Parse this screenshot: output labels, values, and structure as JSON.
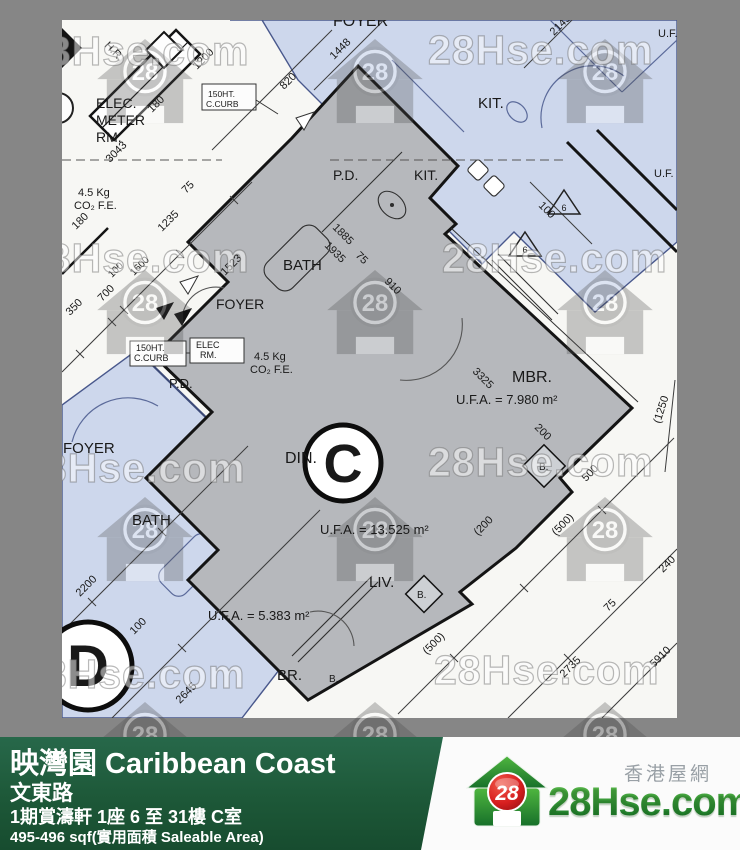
{
  "watermark": {
    "text": "28Hse.com",
    "badge": "28"
  },
  "info_bar": {
    "title": "映灣園 Caribbean Coast",
    "road": "文東路",
    "block": "1期賞濤軒 1座 6 至 31樓 C室",
    "area": "495-496 sqf(實用面積 Saleable Area)"
  },
  "logo": {
    "badge": "28",
    "name": "28Hse.com",
    "tagline": "香港屋網"
  },
  "plan": {
    "unit_letter_c": "C",
    "unit_letter_d": "D",
    "labels": [
      {
        "t": "FOYER",
        "x": 271,
        "y": 6,
        "s": 16
      },
      {
        "t": "KIT.",
        "x": 416,
        "y": 88,
        "s": 15
      },
      {
        "t": "U.F.",
        "x": 596,
        "y": 17,
        "s": 11
      },
      {
        "t": "U.F.",
        "x": 592,
        "y": 157,
        "s": 11
      },
      {
        "t": "P.D.",
        "x": 271,
        "y": 160,
        "s": 14
      },
      {
        "t": "KIT.",
        "x": 352,
        "y": 160,
        "s": 14
      },
      {
        "t": "ELEC.",
        "x": 34,
        "y": 88,
        "s": 14
      },
      {
        "t": "METER",
        "x": 34,
        "y": 105,
        "s": 14
      },
      {
        "t": "RM.",
        "x": 34,
        "y": 122,
        "s": 14
      },
      {
        "t": "150HT.",
        "x": 146,
        "y": 77,
        "s": 8.5
      },
      {
        "t": "C.CURB",
        "x": 144,
        "y": 87,
        "s": 8.5
      },
      {
        "t": "H.R.",
        "x": 42,
        "y": 26,
        "s": 11,
        "r": 45
      },
      {
        "t": "BATH",
        "x": 221,
        "y": 250,
        "s": 15
      },
      {
        "t": "FOYER",
        "x": 154,
        "y": 289,
        "s": 14
      },
      {
        "t": "ELEC",
        "x": 134,
        "y": 328,
        "s": 9
      },
      {
        "t": "RM.",
        "x": 138,
        "y": 338,
        "s": 9
      },
      {
        "t": "150HT.",
        "x": 74,
        "y": 331,
        "s": 9
      },
      {
        "t": "C.CURB",
        "x": 72,
        "y": 341,
        "s": 9
      },
      {
        "t": "4.5 Kg",
        "x": 16,
        "y": 176,
        "s": 11
      },
      {
        "t": "CO₂ F.E.",
        "x": 12,
        "y": 189,
        "s": 11
      },
      {
        "t": "4.5 Kg",
        "x": 192,
        "y": 340,
        "s": 11
      },
      {
        "t": "CO₂ F.E.",
        "x": 188,
        "y": 353,
        "s": 11
      },
      {
        "t": "P.D.",
        "x": 107,
        "y": 368,
        "s": 13
      },
      {
        "t": "DIN.",
        "x": 223,
        "y": 443,
        "s": 16
      },
      {
        "t": "MBR.",
        "x": 450,
        "y": 362,
        "s": 16
      },
      {
        "t": "U.F.A. = 7.980 m²",
        "x": 394,
        "y": 384,
        "s": 13
      },
      {
        "t": "U.F.A. = 13.525 m²",
        "x": 258,
        "y": 514,
        "s": 13
      },
      {
        "t": "U.F.A. = 5.383 m²",
        "x": 146,
        "y": 600,
        "s": 13
      },
      {
        "t": "LIV.",
        "x": 307,
        "y": 567,
        "s": 15
      },
      {
        "t": "BR.",
        "x": 215,
        "y": 660,
        "s": 15
      },
      {
        "t": "B.",
        "x": 477,
        "y": 450,
        "s": 10
      },
      {
        "t": "B.",
        "x": 355,
        "y": 578,
        "s": 10
      },
      {
        "t": "B.",
        "x": 267,
        "y": 662,
        "s": 10
      },
      {
        "t": "BATH",
        "x": 70,
        "y": 505,
        "s": 15
      },
      {
        "t": "FOYER",
        "x": 1,
        "y": 433,
        "s": 15
      },
      {
        "t": "C",
        "x": 281,
        "y": 462,
        "s": 54,
        "b": 1,
        "a": "middle"
      },
      {
        "t": "D",
        "x": 26,
        "y": 666,
        "s": 58,
        "b": 1,
        "a": "middle"
      },
      {
        "t": "6",
        "x": 502,
        "y": 191,
        "s": 9,
        "a": "middle"
      },
      {
        "t": "6",
        "x": 463,
        "y": 233,
        "s": 9,
        "a": "middle"
      },
      {
        "t": "1200",
        "x": 135,
        "y": 50,
        "s": 11,
        "r": -45
      },
      {
        "t": "180",
        "x": 90,
        "y": 93,
        "s": 11,
        "r": -45
      },
      {
        "t": "3043",
        "x": 48,
        "y": 143,
        "s": 11,
        "r": -45
      },
      {
        "t": "75",
        "x": 124,
        "y": 174,
        "s": 11,
        "r": -45
      },
      {
        "t": "1235",
        "x": 100,
        "y": 212,
        "s": 11,
        "r": -45
      },
      {
        "t": "180",
        "x": 14,
        "y": 210,
        "s": 11,
        "r": -45
      },
      {
        "t": "820",
        "x": 222,
        "y": 70,
        "s": 11,
        "r": -45
      },
      {
        "t": "1448",
        "x": 272,
        "y": 40,
        "s": 11,
        "r": -45
      },
      {
        "t": "2145",
        "x": 492,
        "y": 16,
        "s": 11,
        "r": -45
      },
      {
        "t": "100",
        "x": 476,
        "y": 186,
        "s": 11,
        "r": 45
      },
      {
        "t": "1523",
        "x": 163,
        "y": 256,
        "s": 11,
        "r": -45
      },
      {
        "t": "350",
        "x": 8,
        "y": 296,
        "s": 11,
        "r": -45
      },
      {
        "t": "700",
        "x": 40,
        "y": 282,
        "s": 11,
        "r": -45
      },
      {
        "t": "100",
        "x": 50,
        "y": 258,
        "s": 10,
        "r": -45
      },
      {
        "t": "1600",
        "x": 72,
        "y": 256,
        "s": 10,
        "r": -45
      },
      {
        "t": "2200",
        "x": 18,
        "y": 577,
        "s": 11,
        "r": -45
      },
      {
        "t": "100",
        "x": 72,
        "y": 615,
        "s": 11,
        "r": -45
      },
      {
        "t": "2645",
        "x": 118,
        "y": 684,
        "s": 11,
        "r": -45
      },
      {
        "t": "500",
        "x": 524,
        "y": 462,
        "s": 11,
        "r": -45
      },
      {
        "t": "(500)",
        "x": 494,
        "y": 516,
        "s": 11,
        "r": -45
      },
      {
        "t": "(500)",
        "x": 365,
        "y": 635,
        "s": 11,
        "r": -45
      },
      {
        "t": "(200",
        "x": 416,
        "y": 516,
        "s": 11,
        "r": -45
      },
      {
        "t": "75",
        "x": 546,
        "y": 592,
        "s": 11,
        "r": -45
      },
      {
        "t": "240",
        "x": 601,
        "y": 553,
        "s": 11,
        "r": -45
      },
      {
        "t": "2735",
        "x": 502,
        "y": 658,
        "s": 11,
        "r": -45
      },
      {
        "t": "5910",
        "x": 592,
        "y": 648,
        "s": 11,
        "r": -45
      },
      {
        "t": "1885",
        "x": 270,
        "y": 208,
        "s": 11,
        "r": 45
      },
      {
        "t": "1935",
        "x": 262,
        "y": 226,
        "s": 11,
        "r": 45
      },
      {
        "t": "75",
        "x": 293,
        "y": 236,
        "s": 11,
        "r": 45
      },
      {
        "t": "910",
        "x": 322,
        "y": 262,
        "s": 11,
        "r": 45
      },
      {
        "t": "3325",
        "x": 410,
        "y": 352,
        "s": 11,
        "r": 45
      },
      {
        "t": "200",
        "x": 472,
        "y": 408,
        "s": 11,
        "r": 45
      },
      {
        "t": "(1250",
        "x": 598,
        "y": 404,
        "s": 11,
        "r": -72
      }
    ],
    "watermark_texts": [
      {
        "x": -38,
        "y": 45
      },
      {
        "x": 366,
        "y": 44
      },
      {
        "x": -38,
        "y": 252
      },
      {
        "x": 380,
        "y": 252
      },
      {
        "x": -42,
        "y": 462
      },
      {
        "x": 366,
        "y": 456
      },
      {
        "x": -42,
        "y": 668
      },
      {
        "x": 372,
        "y": 664
      }
    ],
    "watermark_houses": [
      {
        "x": 83,
        "y": 62
      },
      {
        "x": 313,
        "y": 62
      },
      {
        "x": 543,
        "y": 62
      },
      {
        "x": 83,
        "y": 293
      },
      {
        "x": 313,
        "y": 293
      },
      {
        "x": 543,
        "y": 293
      },
      {
        "x": 83,
        "y": 520
      },
      {
        "x": 313,
        "y": 520
      },
      {
        "x": 543,
        "y": 520
      }
    ],
    "watermark_houses_row4": [
      145,
      375,
      605
    ]
  }
}
